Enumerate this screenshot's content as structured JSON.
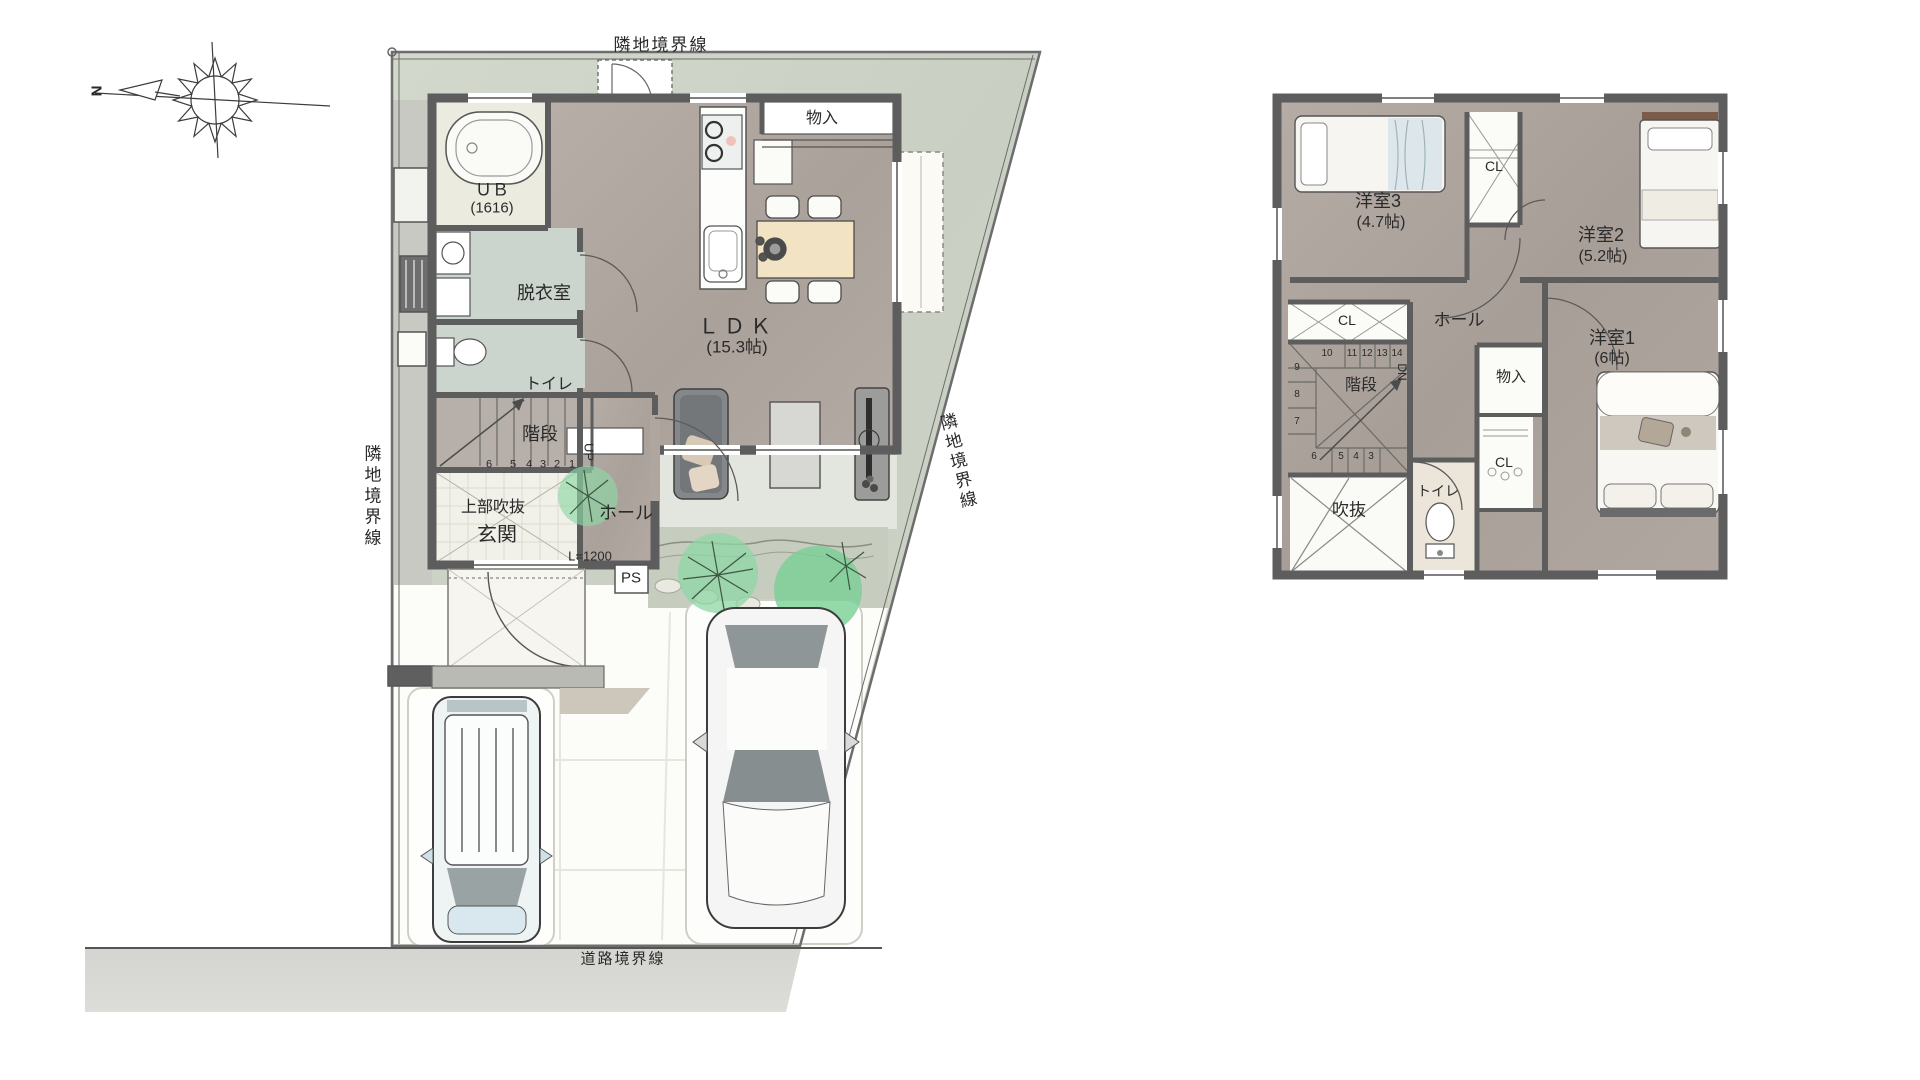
{
  "compass": {
    "north_label": "N"
  },
  "boundaries": {
    "top": "隣地境界線",
    "left": "隣地境界線",
    "right": "隣地境界線",
    "road": "道路境界線"
  },
  "floor1": {
    "rooms": {
      "ub": {
        "name": "ＵＢ",
        "size": "(1616)"
      },
      "dressing": {
        "name": "脱衣室"
      },
      "toilet": {
        "name": "トイレ"
      },
      "stairs": {
        "name": "階段",
        "direction": "UP",
        "numbers": [
          "6",
          "5",
          "4",
          "3",
          "2",
          "1"
        ]
      },
      "void_above": {
        "name": "上部吹抜"
      },
      "entrance": {
        "name": "玄関"
      },
      "hall": {
        "name": "ホール"
      },
      "ldk": {
        "name": "ＬＤＫ",
        "size": "(15.3帖)"
      },
      "storage": {
        "name": "物入"
      }
    },
    "labels": {
      "ps": "PS",
      "entrance_width": "L=1200"
    }
  },
  "floor2": {
    "rooms": {
      "bedroom3": {
        "name": "洋室3",
        "size": "(4.7帖)"
      },
      "bedroom2": {
        "name": "洋室2",
        "size": "(5.2帖)"
      },
      "bedroom1": {
        "name": "洋室1",
        "size": "(6帖)"
      },
      "closet_top": "CL",
      "closet_left": "CL",
      "closet_bottom": "CL",
      "hall": {
        "name": "ホール"
      },
      "storage": {
        "name": "物入"
      },
      "stairs": {
        "name": "階段",
        "direction": "DN",
        "numbers_top": [
          "10",
          "11",
          "12",
          "13",
          "14"
        ],
        "numbers_left": [
          "9",
          "8",
          "7"
        ],
        "numbers_bottom": [
          "6",
          "5",
          "4",
          "3"
        ]
      },
      "toilet": {
        "name": "トイレ"
      },
      "void": {
        "name": "吹抜"
      }
    }
  },
  "palette": {
    "wall": "#5d5d5d",
    "room_floor": "#b2a8a2",
    "wet_floor": "#cbd4cd",
    "site_green": "#cfd5c9",
    "road_gray": "#d8d9d5",
    "tree_green": "#7fd29a",
    "wood": "#f2e3c4"
  }
}
